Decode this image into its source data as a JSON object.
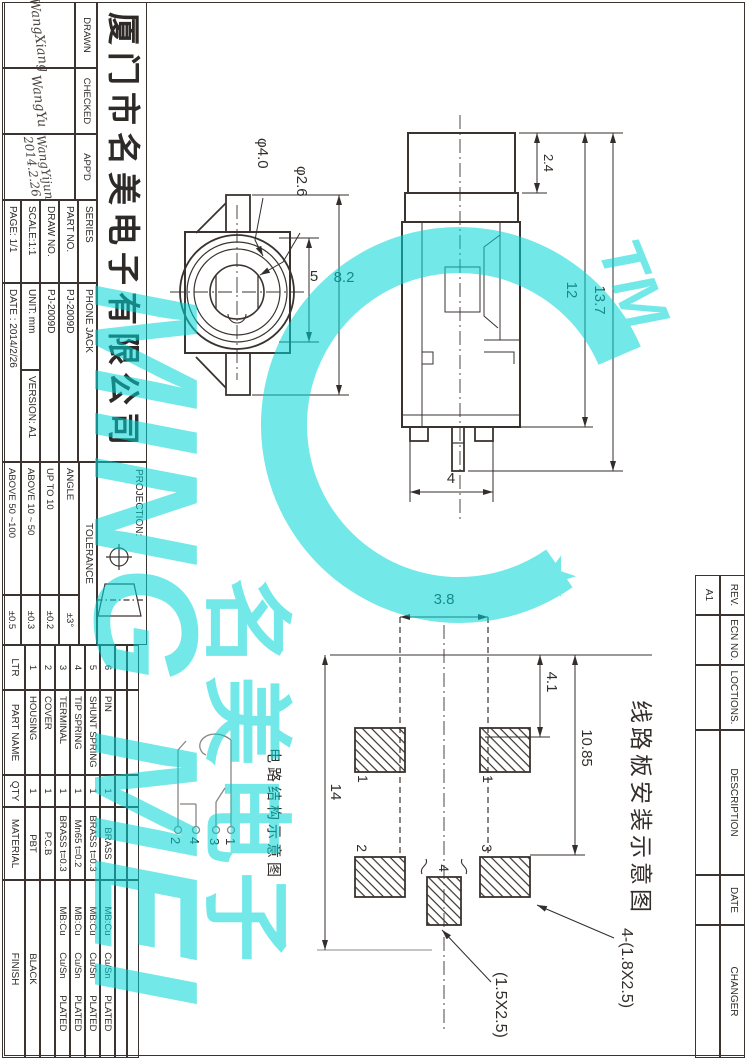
{
  "sheet": {
    "company_name": "厦门市名美电子有限公司",
    "signatures": {
      "drawn_label": "DRAWN",
      "drawn_name": "WangXiang",
      "checked_label": "CHECKED",
      "checked_name": "WangYu",
      "approved_label": "APP'D",
      "approved_name": "WangYijun",
      "approved_date": "2014.2.26"
    },
    "fields": {
      "series_label": "SERIES",
      "series_value": "PHONE JACK",
      "part_no_label": "PART NO.",
      "part_no_value": "PJ-2009D",
      "draw_no_label": "DRAW NO.",
      "draw_no_value": "PJ-2009D",
      "scale": "SCALE:1:1",
      "unit": "UNIT: mm",
      "version": "VERSION: A1",
      "page": "PAGE: 1/1",
      "date": "DATE : 2014/2/26"
    },
    "projection_label": "PROJECTION:",
    "tolerance": {
      "header": "TOLERANCE",
      "rows": [
        {
          "range": "ANGLE",
          "value": "±3°"
        },
        {
          "range": "UP TO 10",
          "value": "±0.2"
        },
        {
          "range": "ABOVE 10 ~ 50",
          "value": "±0.3"
        },
        {
          "range": "ABOVE 50 ~100",
          "value": "±0.5"
        }
      ]
    },
    "bom": {
      "headers": {
        "ltr": "LTR",
        "part_name": "PART NAME",
        "qty": "QTY",
        "material": "MATERIAL",
        "finish": "FINISH"
      },
      "rows": [
        {
          "ltr": "6",
          "part_name": "PIN",
          "qty": "1",
          "material": "BRASS",
          "finish": "MB:Cu Cu/Sn PLATED"
        },
        {
          "ltr": "5",
          "part_name": "SHUNT SPRING",
          "qty": "1",
          "material": "BRASS t=0.3",
          "finish": "MB:Cu Cu/Sn PLATED"
        },
        {
          "ltr": "4",
          "part_name": "TIP SPRING",
          "qty": "1",
          "material": "Mn65 t=0.2",
          "finish": "MB:Cu Cu/Sn PLATED"
        },
        {
          "ltr": "3",
          "part_name": "TERMINAL",
          "qty": "1",
          "material": "BRASS t=0.3",
          "finish": "MB:Cu Cu/Sn PLATED"
        },
        {
          "ltr": "2",
          "part_name": "COVER",
          "qty": "1",
          "material": "P.C.B",
          "finish": ""
        },
        {
          "ltr": "1",
          "part_name": "HOUSING",
          "qty": "1",
          "material": "PBT",
          "finish": "BLACK"
        }
      ]
    },
    "rev_table": {
      "headers": {
        "rev": "REV.",
        "ecn": "ECN NO.",
        "locations": "LOCTIONS.",
        "description": "DESCRIPTION",
        "date": "DATE",
        "changer": "CHANGER"
      },
      "row": {
        "rev": "A1",
        "ecn": "",
        "locations": "",
        "description": "",
        "date": "",
        "changer": ""
      }
    },
    "views": {
      "front": {
        "dia_outer": "φ4.0",
        "dia_inner": "φ2.6",
        "dim_inner": "5",
        "dim_overall": "8.2"
      },
      "side": {
        "dim_top": "2.4",
        "dim_body": "12",
        "dim_overall": "13.7",
        "dim_pin": "4"
      },
      "pcb": {
        "title": "线路板安装示意图",
        "dim_pitch": "3.8",
        "dim_a": "4.1",
        "dim_b": "10.85",
        "dim_overall": "14",
        "pad_labels": [
          "1",
          "1",
          "3",
          "2",
          "4"
        ],
        "note_holes": "4-(1.8X2.5)",
        "note_center": "(1.5X2.5)"
      },
      "schematic": {
        "title": "电路结构示意图",
        "pin_labels": [
          "1",
          "3",
          "4",
          "2"
        ]
      }
    },
    "watermark": {
      "text_latin": "MING MEI",
      "text_cjk": "名美电子",
      "tm": "TM",
      "star": "★",
      "color": "#00d6d6"
    }
  }
}
